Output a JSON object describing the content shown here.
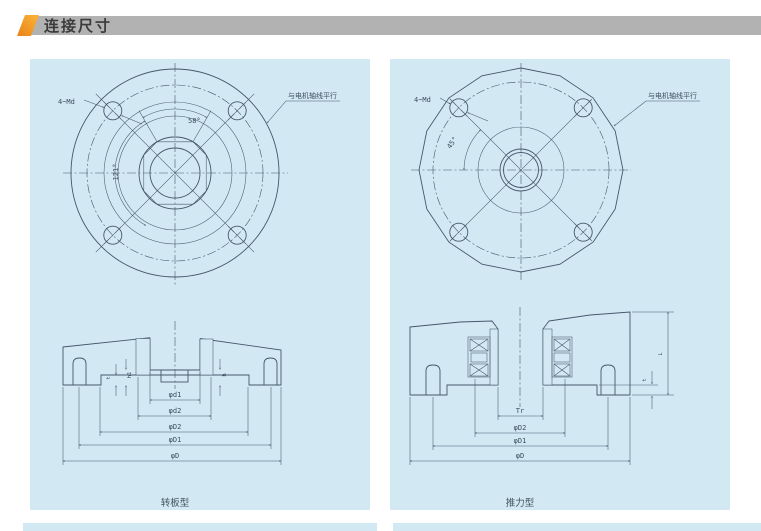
{
  "header": {
    "title": "连接尺寸"
  },
  "colors": {
    "panel_bg": "#d2e9f4",
    "line": "#46566a",
    "header_bg": "#b2b2b2",
    "header_text": "#3b3b3b",
    "accent_orange": "#e8831a",
    "accent_yellow": "#fcb53a"
  },
  "panels": {
    "left": {
      "caption": "转板型",
      "labels": {
        "bolt": "4~Md",
        "angle_top": "58°",
        "angle_side": "121°",
        "note": "与电机轴线平行"
      },
      "dims": [
        "φd1",
        "φd2",
        "φD2",
        "φD1",
        "φD"
      ],
      "small_dims": [
        "t",
        "h1",
        "h"
      ]
    },
    "right": {
      "caption": "推力型",
      "labels": {
        "bolt": "4~Md",
        "angle_side": "45°",
        "note": "与电机轴线平行"
      },
      "dims": [
        "Tr",
        "φD2",
        "φD1",
        "φD"
      ],
      "small_dims": [
        "L",
        "t"
      ]
    }
  }
}
